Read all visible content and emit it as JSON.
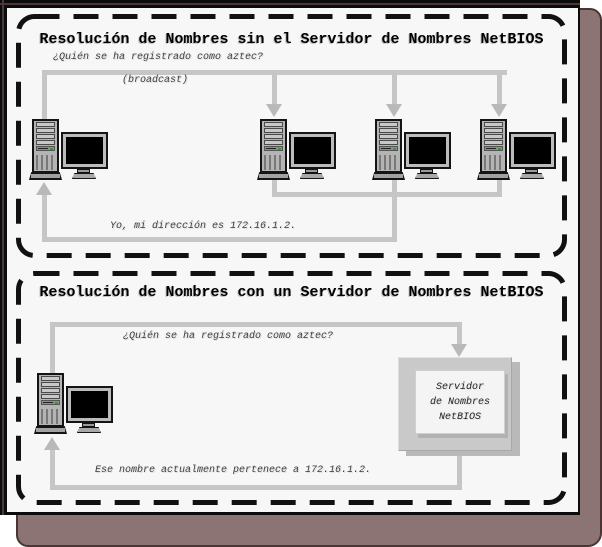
{
  "panel1": {
    "title": "Resolución de Nombres sin el Servidor de Nombres NetBIOS",
    "question_label": "¿Quién se ha registrado como aztec?",
    "broadcast_label": "(broadcast)",
    "reply_label": "Yo, mi dirección es 172.16.1.2."
  },
  "panel2": {
    "title": "Resolución de Nombres con un Servidor de Nombres NetBIOS",
    "question_label": "¿Quién se ha registrado como aztec?",
    "reply_label": "Ese nombre actualmente pertenece a 172.16.1.2.",
    "server_box": {
      "line1": "Servidor",
      "line2": "de Nombres",
      "line3": "NetBIOS"
    }
  },
  "colors": {
    "canvas_background": "#f7f7f7",
    "frame_shadow": "#8c7474",
    "dashed_border": "#111111",
    "connector_line": "#c6c6c6",
    "arrow_fill": "#b9b9b9",
    "computer_gray": "#b4b4b4",
    "server_box_outer": "#c9c9c9",
    "server_box_inner": "#f4f4f4",
    "screen_black": "#000000"
  }
}
